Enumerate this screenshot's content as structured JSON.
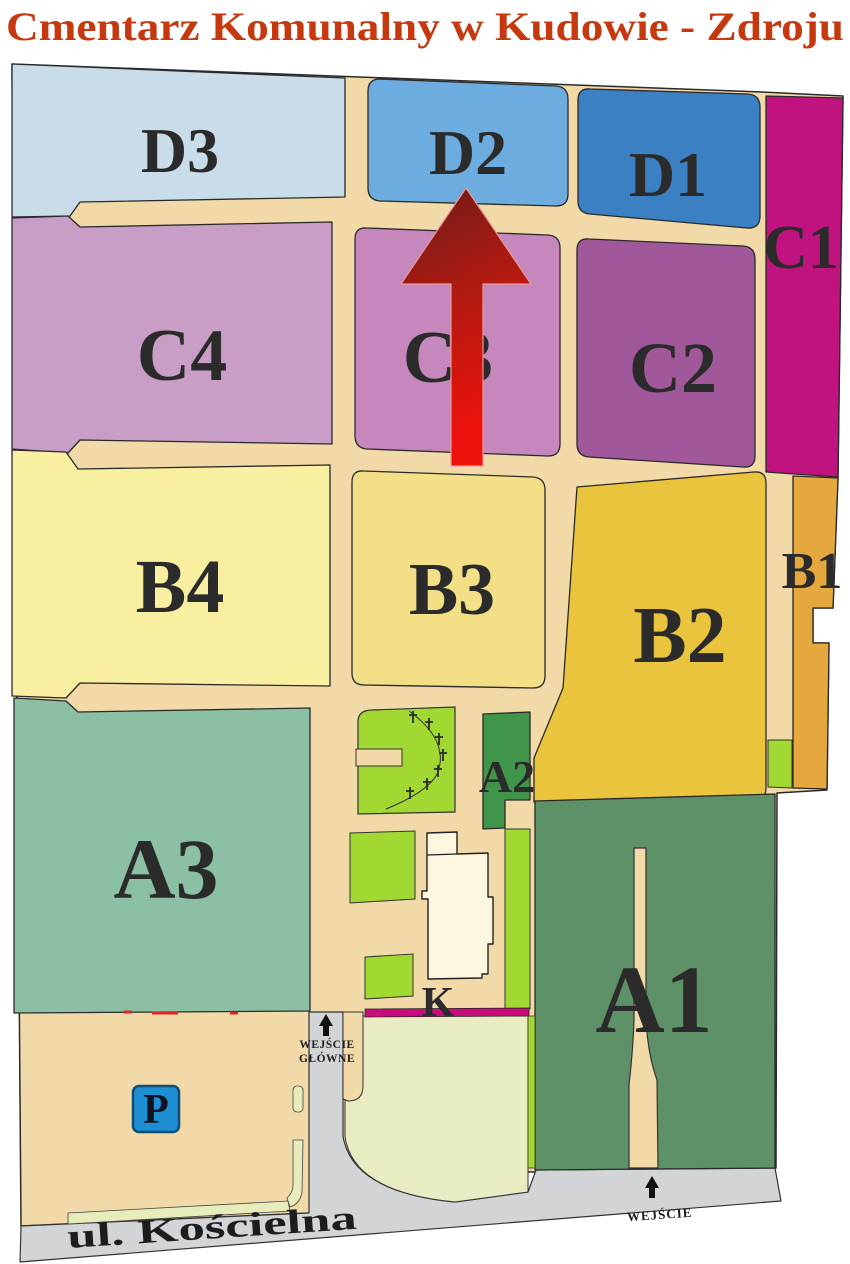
{
  "title": {
    "text": "Cmentarz Komunalny w Kudowie - Zdroju",
    "color": "#c6380e"
  },
  "sections": [
    {
      "id": "D3",
      "label": "D3",
      "color": "#c9dcea"
    },
    {
      "id": "D2",
      "label": "D2",
      "color": "#6cacdf"
    },
    {
      "id": "D1",
      "label": "D1",
      "color": "#3a80c2"
    },
    {
      "id": "C1",
      "label": "C1",
      "color": "#c0137f"
    },
    {
      "id": "C4",
      "label": "C4",
      "color": "#c89dc6"
    },
    {
      "id": "C3",
      "label": "C3",
      "color": "#c687bd"
    },
    {
      "id": "C2",
      "label": "C2",
      "color": "#a1589a"
    },
    {
      "id": "B4",
      "label": "B4",
      "color": "#f8f0a0"
    },
    {
      "id": "B3",
      "label": "B3",
      "color": "#f3df86"
    },
    {
      "id": "B2",
      "label": "B2",
      "color": "#e9c43c"
    },
    {
      "id": "B1",
      "label": "B1",
      "color": "#e5a83e"
    },
    {
      "id": "A3",
      "label": "A3",
      "color": "#8cc0a5"
    },
    {
      "id": "A2",
      "label": "A2",
      "color": "#41954a"
    },
    {
      "id": "A1",
      "label": "A1",
      "color": "#5e9168"
    }
  ],
  "labels": {
    "chapel": "K",
    "parking": "P",
    "street": "ul. Kościelna",
    "entrance_main_1": "WEJŚCIE",
    "entrance_main_2": "GŁÓWNE",
    "entrance_side": "WEJŚCIE"
  },
  "colors": {
    "path_tan": "#f1d9a8",
    "road_gray": "#d2d4d6",
    "plaza": "#e9ecc3",
    "curb": "#e6edba",
    "lime": "#a2d832",
    "chapel_building": "#fbf6dd",
    "magenta_strip": "#cb0b7c",
    "red_gate_marks": "#e0251f",
    "parking_sign_blue": "#1d8fd2",
    "arrow_dark": "#6b1c1a",
    "arrow_mid": "#b51a10",
    "arrow_bright": "#ed120c",
    "label_dark": "#2b2b2b"
  }
}
